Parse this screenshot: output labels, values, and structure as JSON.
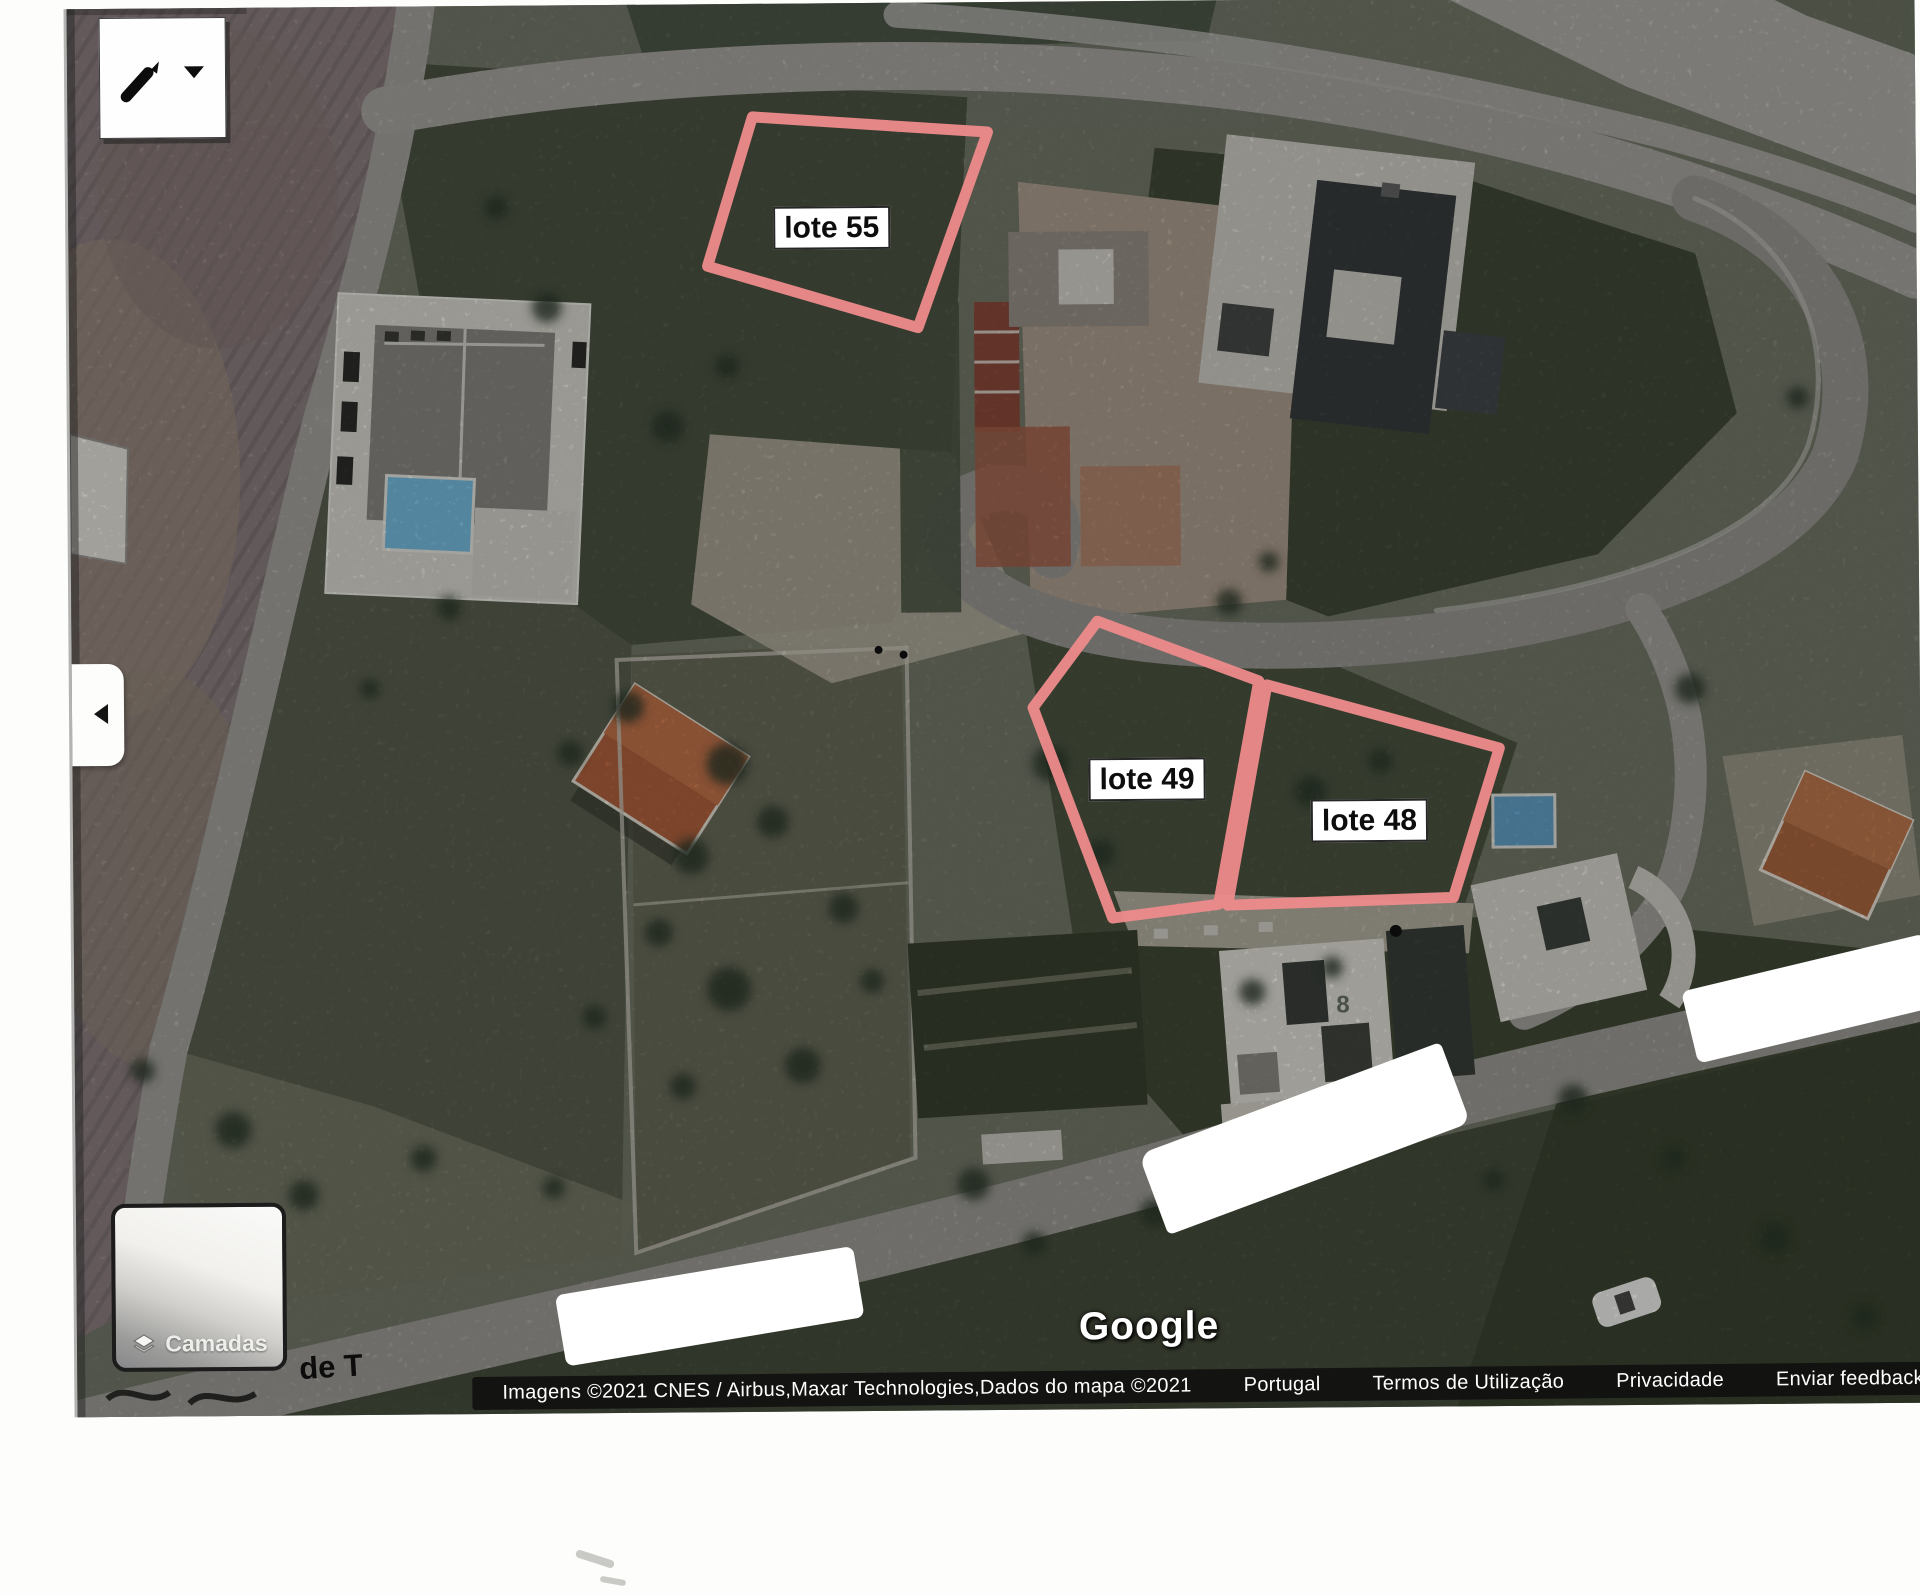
{
  "map": {
    "lots": [
      {
        "label": "lote 55"
      },
      {
        "label": "lote 49"
      },
      {
        "label": "lote 48"
      }
    ],
    "house_number": "8",
    "partial_street_label": "de T",
    "watermark": "Google"
  },
  "controls": {
    "layers_button_label": "Camadas",
    "icons": {
      "draw_tool": "pencil-icon",
      "draw_tool_caret": "dropdown-caret-icon",
      "collapse_panel": "left-arrow-icon",
      "layers": "layers-icon"
    }
  },
  "attribution": {
    "imagery_credit": "Imagens ©2021 CNES / Airbus,Maxar Technologies,Dados do mapa ©2021",
    "links": [
      {
        "label": "Portugal"
      },
      {
        "label": "Termos de Utilização"
      },
      {
        "label": "Privacidade"
      },
      {
        "label": "Enviar feedback"
      }
    ]
  },
  "colors": {
    "lot_outline": "#ee8b8b",
    "label_background": "#ffffff",
    "label_text": "#111111",
    "attribution_background": "#131313",
    "attribution_text": "#ffffff"
  }
}
